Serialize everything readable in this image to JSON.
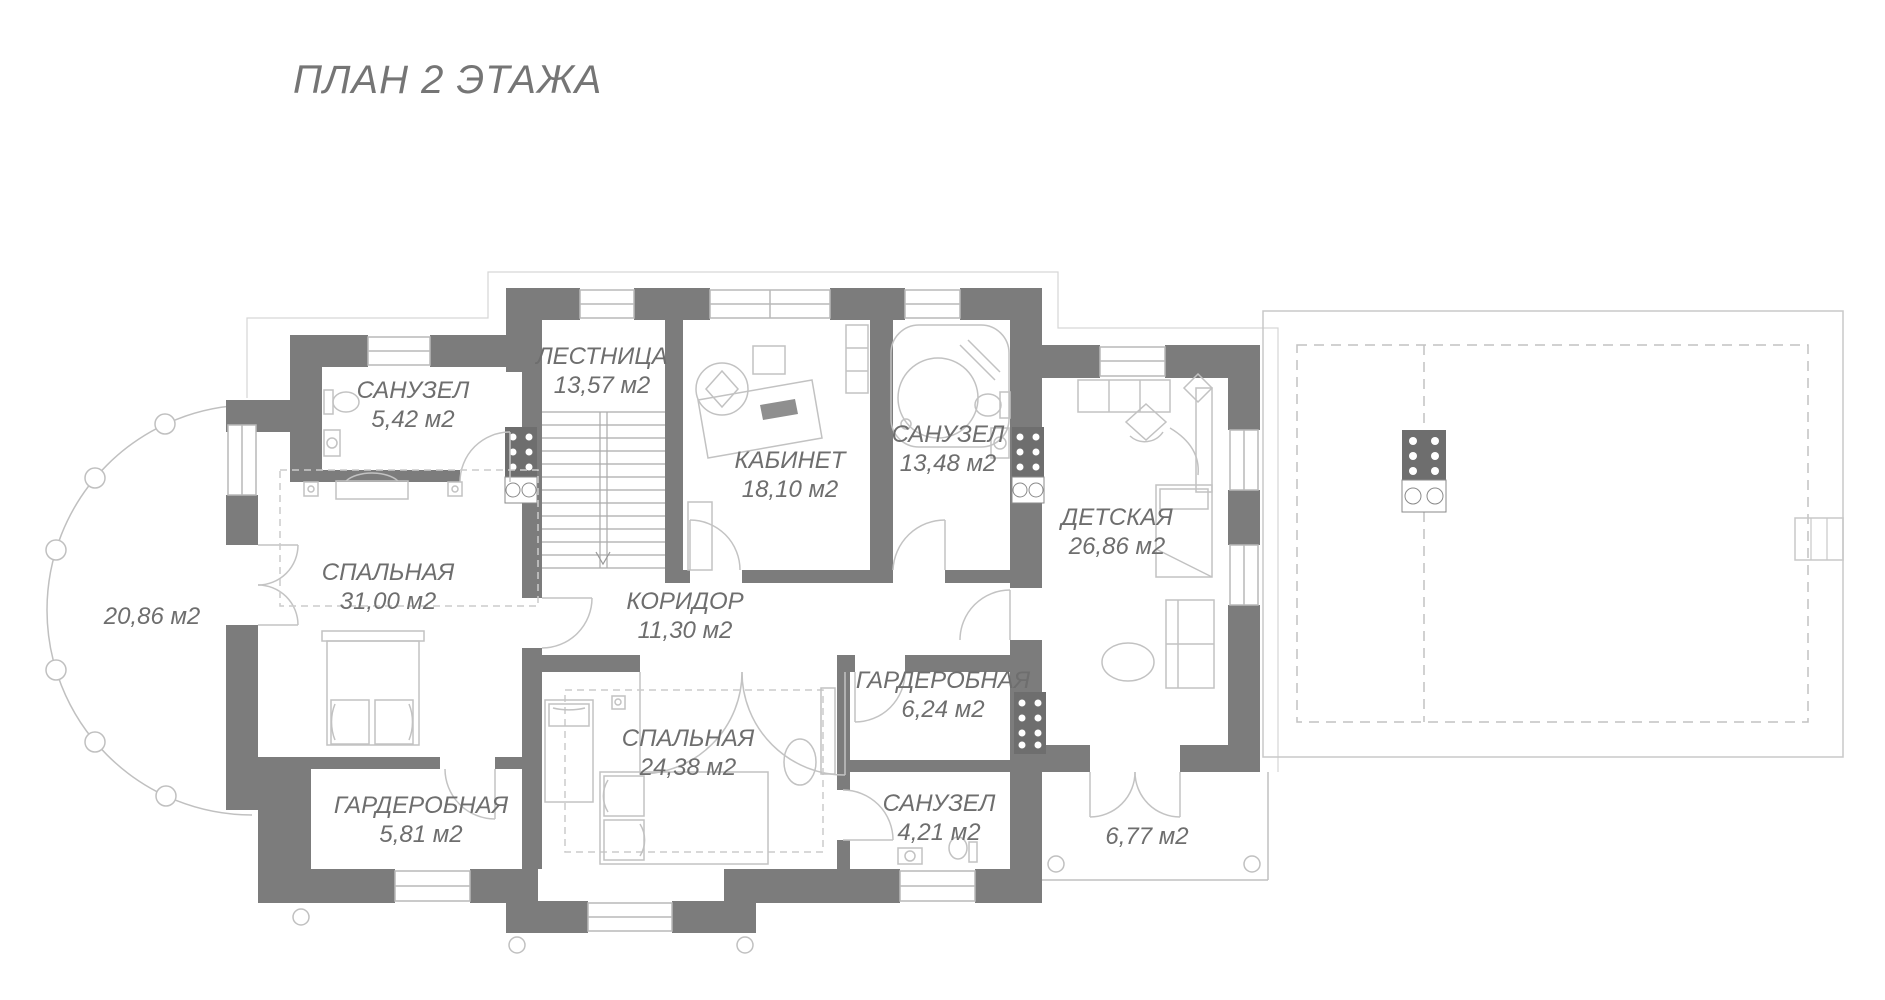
{
  "title": "ПЛАН 2 ЭТАЖА",
  "plan": {
    "rooms": [
      {
        "name": "САНУЗЕЛ",
        "area": "5,42 м2"
      },
      {
        "name": "ЛЕСТНИЦА",
        "area": "13,57 м2"
      },
      {
        "name": "КАБИНЕТ",
        "area": "18,10 м2"
      },
      {
        "name": "САНУЗЕЛ",
        "area": "13,48 м2"
      },
      {
        "name": "ДЕТСКАЯ",
        "area": "26,86 м2"
      },
      {
        "name": "СПАЛЬНАЯ",
        "area": "31,00 м2"
      },
      {
        "name": "КОРИДОР",
        "area": "11,30 м2"
      },
      {
        "name": "ГАРДЕРОБНАЯ",
        "area": "6,24 м2"
      },
      {
        "name": "СПАЛЬНАЯ",
        "area": "24,38 м2"
      },
      {
        "name": "ГАРДЕРОБНАЯ",
        "area": "5,81 м2"
      },
      {
        "name": "САНУЗЕЛ",
        "area": "4,21 м2"
      }
    ],
    "open_areas": [
      {
        "area": "20,86 м2"
      },
      {
        "area": "6,77 м2"
      }
    ]
  },
  "colors": {
    "wall": "#7c7c7c",
    "thin_line": "#c3c3c3",
    "text": "#6e6e6e"
  }
}
